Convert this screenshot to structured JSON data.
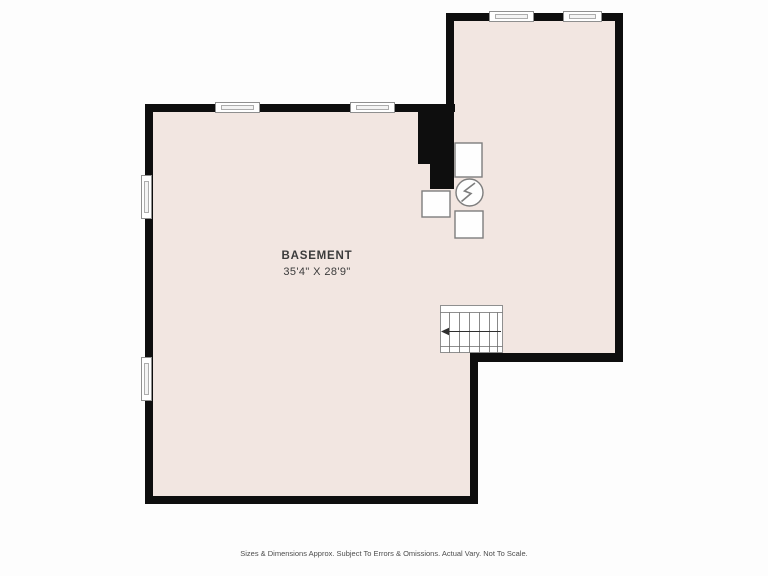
{
  "floorplan": {
    "room": {
      "label": "BASEMENT",
      "dimensions": "35'4\" X 28'9\""
    },
    "footer": {
      "disclaimer": "Sizes & Dimensions Approx. Subject To Errors & Omissions. Actual Vary. Not To Scale."
    },
    "colors": {
      "wall": "#0e0e0e",
      "floor": "#f2e6e1",
      "window_border": "#8f8f8f",
      "fixture_border": "#7d7d7d",
      "label_text": "#3b3b3b",
      "footer_text": "#4d4d4d",
      "background": "#fdfdfd"
    },
    "icons": {
      "utility-meter-icon": "circle with lightning bolt",
      "stairs-icon": "stair treads with left-pointing direction arrow",
      "window-icon": "double-line window symbol"
    }
  }
}
